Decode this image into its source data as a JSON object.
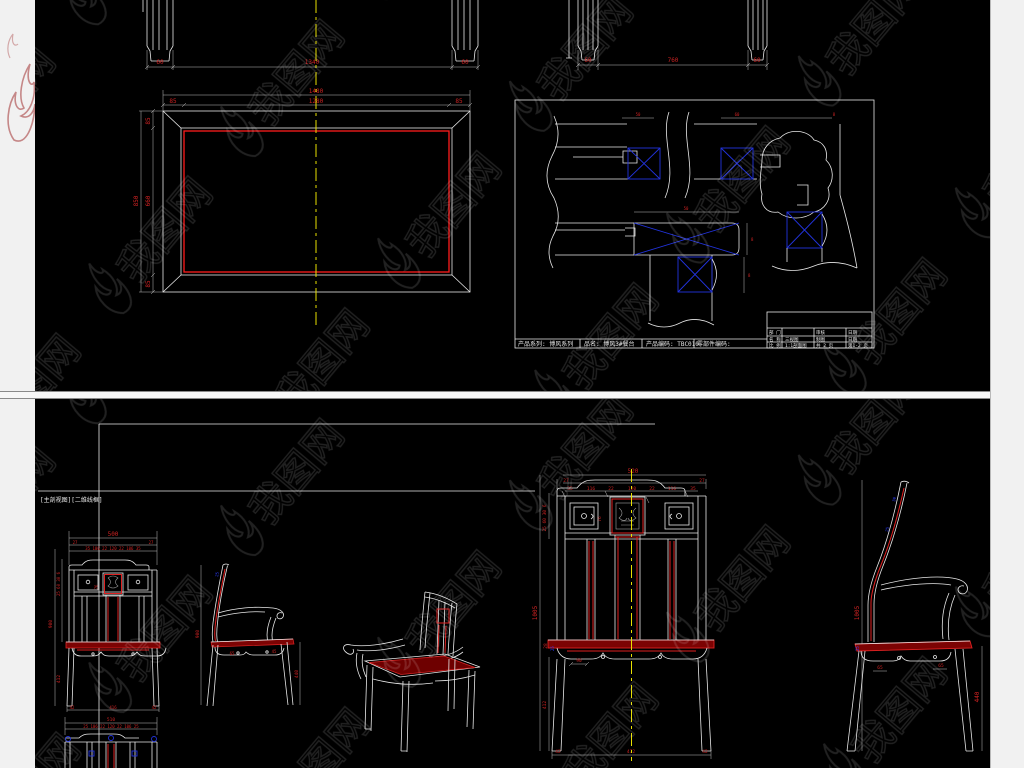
{
  "watermark": {
    "brand": "我图网"
  },
  "top": {
    "front_dims": {
      "l": "60",
      "c": "1340",
      "r": "60"
    },
    "side_dims": {
      "l": "60",
      "c": "760",
      "r": "60"
    },
    "plan_dims": {
      "w": "1480",
      "iw": "1280",
      "el": "85",
      "er": "85",
      "h": "850",
      "ih": "660",
      "et": "85",
      "eb": "85"
    },
    "detail_dims": {
      "d1": "50",
      "d2": "60",
      "d3": "8",
      "d4": "50",
      "d5": "8",
      "d6": "8"
    },
    "footer": {
      "series": "产品系列: 博风系列",
      "name": "品名: 博风3#餐台",
      "code": "产品编码: TBC010",
      "part": "零部件编码:"
    },
    "tb": {
      "r1a": "部 门",
      "r1b": "审核",
      "r1c": "日期",
      "r2a": "名 称",
      "r2b": "三视图",
      "r2c": "制图",
      "r2d": "日期",
      "r3a": "比 例",
      "r3b": "1:1剖面图",
      "r3c": "共 2 页",
      "r3d": "第1-2 页"
    }
  },
  "bottom": {
    "view_label": "[主剖视图][二维线框]",
    "sf": {
      "w": "500",
      "e1": "27",
      "e2": "27",
      "row": "35 106 22 120 22 106 35",
      "stack": "25 60 30 6",
      "panel": "76",
      "h": "900",
      "leg": "412",
      "b1": "42",
      "b2": "416",
      "b3": "42"
    },
    "ss": {
      "h": "900",
      "a": "65",
      "b": "45",
      "leg": "440",
      "blue": "25"
    },
    "bf": {
      "w": "520",
      "e1": "27",
      "e2": "27",
      "r1": "35",
      "r2": "116",
      "r3": "22",
      "r4": "120",
      "r5": "22",
      "r6": "116",
      "r7": "35",
      "stack": "25 60 30 6",
      "panel": "76",
      "h": "1005",
      "seat": "28",
      "apron": "90",
      "leg": "412",
      "b1": "42",
      "b2": "472",
      "b3": "42",
      "blue": "25"
    },
    "bs": {
      "h": "1005",
      "a": "65",
      "b": "65",
      "leg": "440",
      "blue1": "30",
      "blue2": "25",
      "blue3": "25"
    },
    "bk": {
      "w": "510",
      "row": "25 106 22 120 22 106 25"
    }
  }
}
